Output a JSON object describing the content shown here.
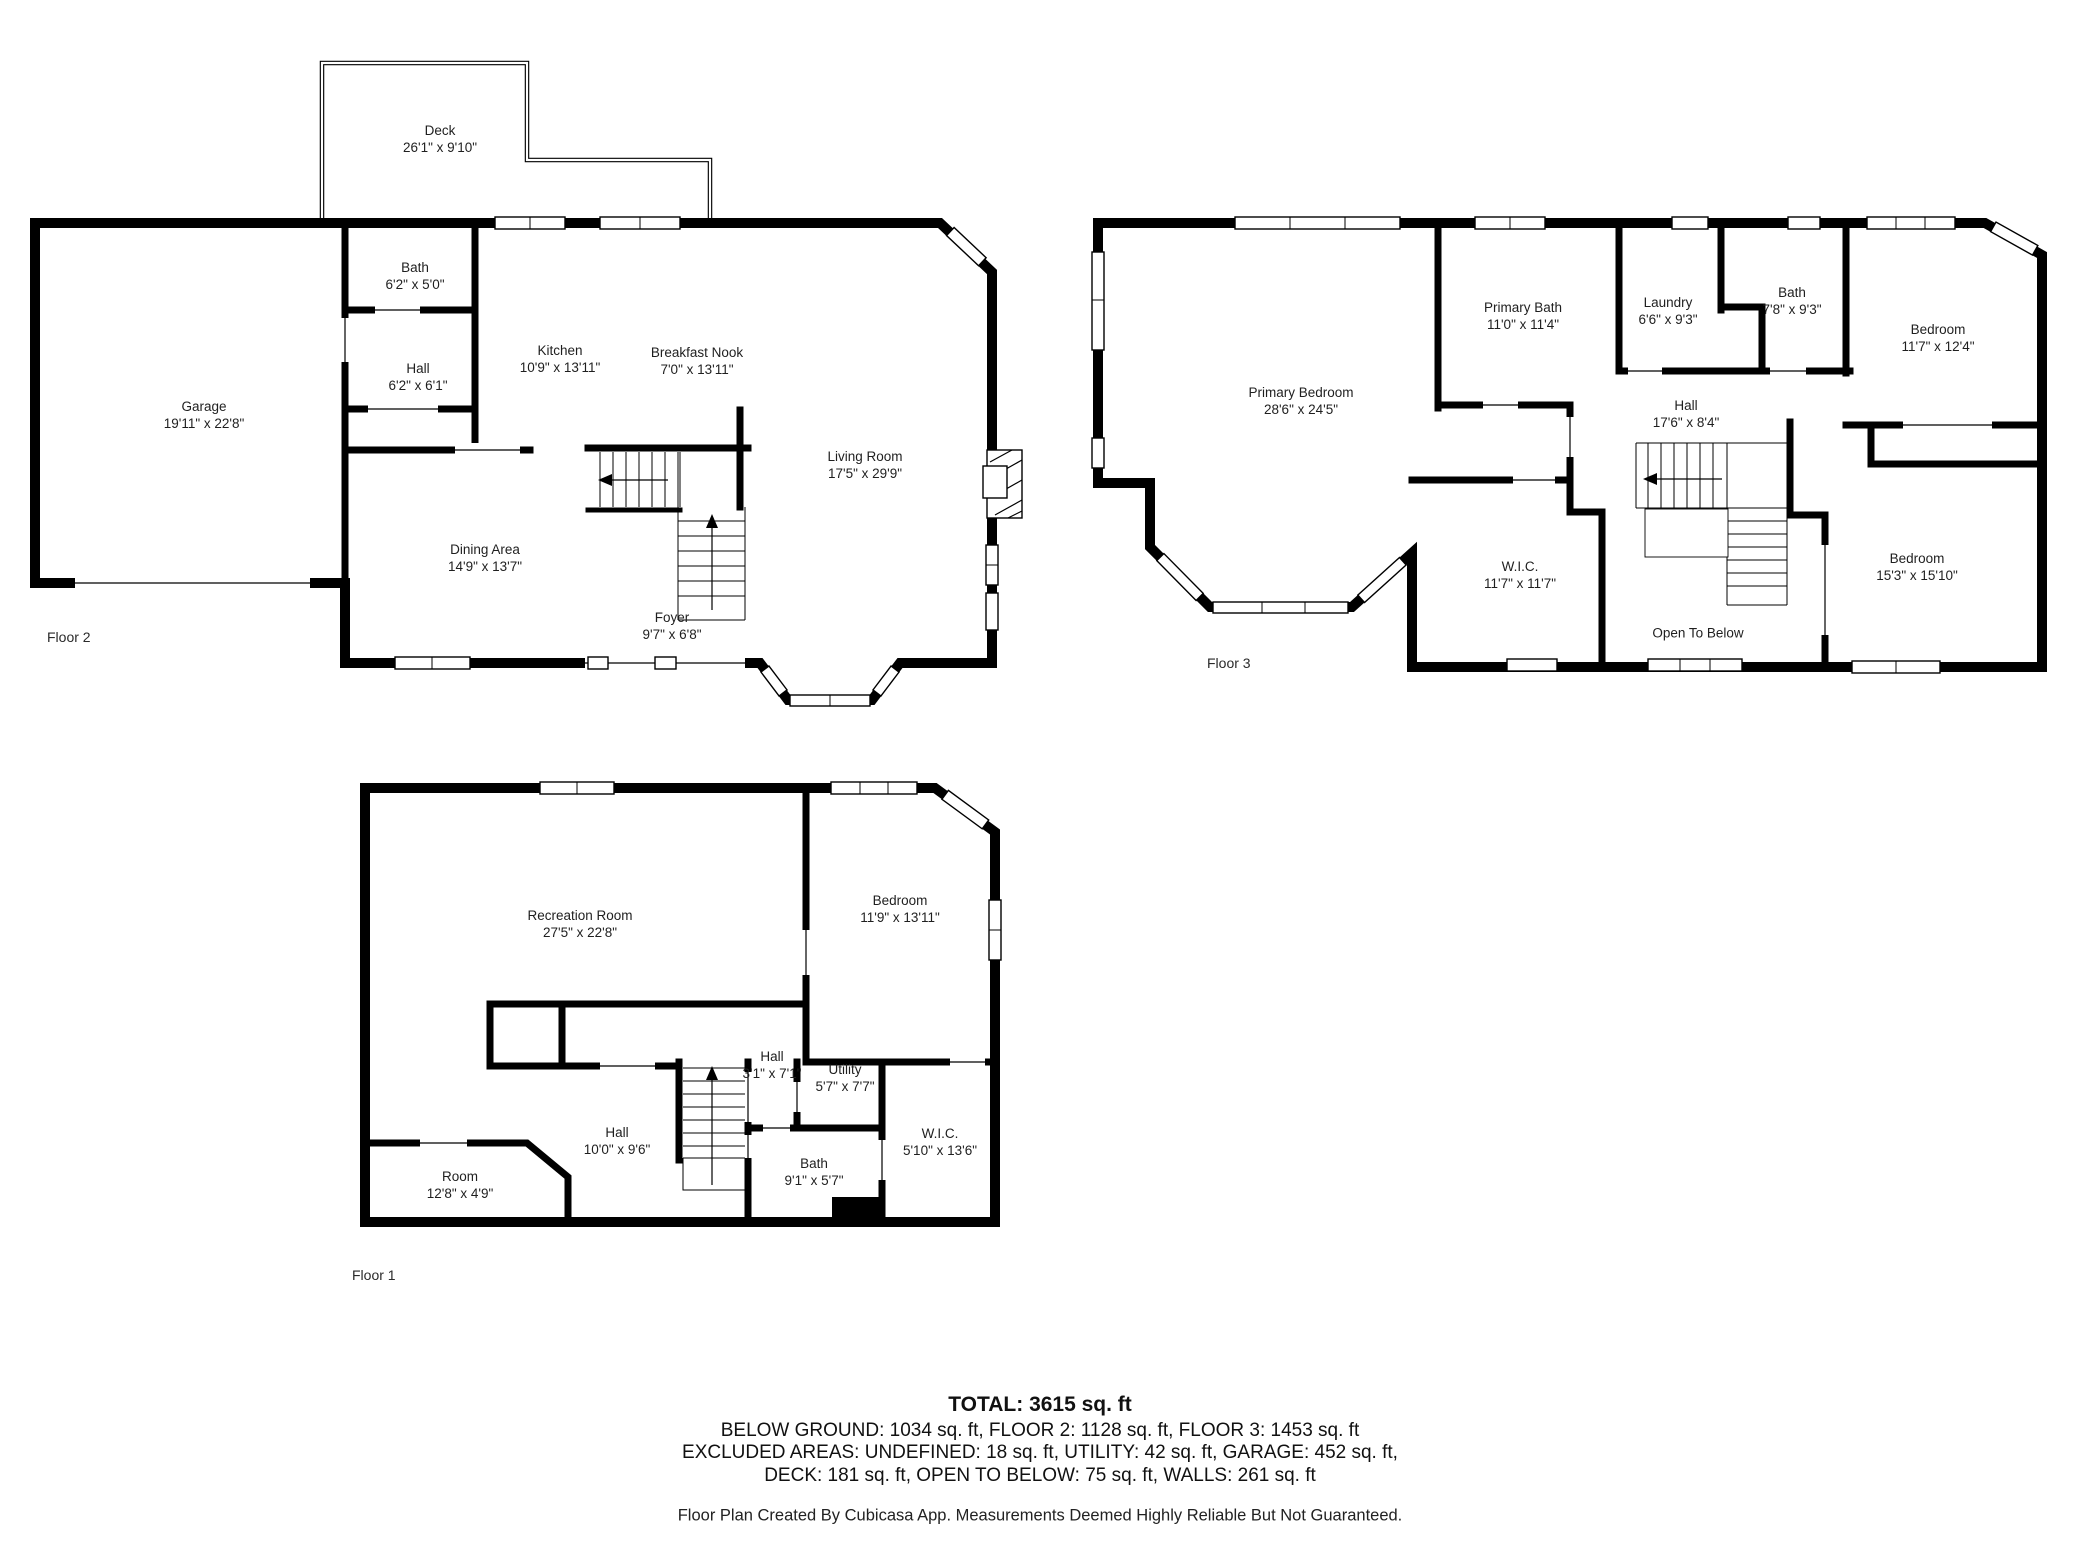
{
  "floors": {
    "floor2": {
      "label": "Floor 2",
      "rooms": {
        "deck": {
          "name": "Deck",
          "dims": "26'1\" x 9'10\""
        },
        "bath": {
          "name": "Bath",
          "dims": "6'2\" x 5'0\""
        },
        "hall": {
          "name": "Hall",
          "dims": "6'2\" x 6'1\""
        },
        "kitchen": {
          "name": "Kitchen",
          "dims": "10'9\" x 13'11\""
        },
        "breakfast_nook": {
          "name": "Breakfast Nook",
          "dims": "7'0\" x 13'11\""
        },
        "garage": {
          "name": "Garage",
          "dims": "19'11\" x 22'8\""
        },
        "living_room": {
          "name": "Living Room",
          "dims": "17'5\" x 29'9\""
        },
        "dining_area": {
          "name": "Dining Area",
          "dims": "14'9\" x 13'7\""
        },
        "foyer": {
          "name": "Foyer",
          "dims": "9'7\" x 6'8\""
        }
      }
    },
    "floor3": {
      "label": "Floor 3",
      "rooms": {
        "primary_bedroom": {
          "name": "Primary Bedroom",
          "dims": "28'6\" x 24'5\""
        },
        "primary_bath": {
          "name": "Primary Bath",
          "dims": "11'0\" x 11'4\""
        },
        "laundry": {
          "name": "Laundry",
          "dims": "6'6\" x 9'3\""
        },
        "bath": {
          "name": "Bath",
          "dims": "7'8\" x 9'3\""
        },
        "bedroom_upper": {
          "name": "Bedroom",
          "dims": "11'7\" x 12'4\""
        },
        "hall": {
          "name": "Hall",
          "dims": "17'6\" x 8'4\""
        },
        "wic": {
          "name": "W.I.C.",
          "dims": "11'7\" x 11'7\""
        },
        "open_to_below": {
          "name": "Open To Below"
        },
        "bedroom_lower": {
          "name": "Bedroom",
          "dims": "15'3\" x 15'10\""
        }
      }
    },
    "floor1": {
      "label": "Floor 1",
      "rooms": {
        "recreation_room": {
          "name": "Recreation Room",
          "dims": "27'5\" x 22'8\""
        },
        "bedroom": {
          "name": "Bedroom",
          "dims": "11'9\" x 13'11\""
        },
        "hall_small": {
          "name": "Hall",
          "dims": "3'1\" x 7'1\""
        },
        "utility": {
          "name": "Utility",
          "dims": "5'7\" x 7'7\""
        },
        "wic": {
          "name": "W.I.C.",
          "dims": "5'10\" x 13'6\""
        },
        "hall": {
          "name": "Hall",
          "dims": "10'0\" x 9'6\""
        },
        "bath": {
          "name": "Bath",
          "dims": "9'1\" x 5'7\""
        },
        "room": {
          "name": "Room",
          "dims": "12'8\" x 4'9\""
        }
      }
    }
  },
  "summary": {
    "total": "TOTAL: 3615 sq. ft",
    "line1": "BELOW GROUND: 1034 sq. ft, FLOOR 2: 1128 sq. ft, FLOOR 3: 1453 sq. ft",
    "line2": "EXCLUDED AREAS: UNDEFINED: 18 sq. ft, UTILITY: 42 sq. ft, GARAGE: 452 sq. ft,",
    "line3": "DECK: 181 sq. ft, OPEN TO BELOW: 75 sq. ft, WALLS: 261 sq. ft",
    "credit": "Floor Plan Created By Cubicasa App. Measurements Deemed Highly Reliable But Not Guaranteed."
  },
  "colors": {
    "wall": "#000000",
    "background": "#ffffff",
    "text": "#1f1f1f"
  }
}
